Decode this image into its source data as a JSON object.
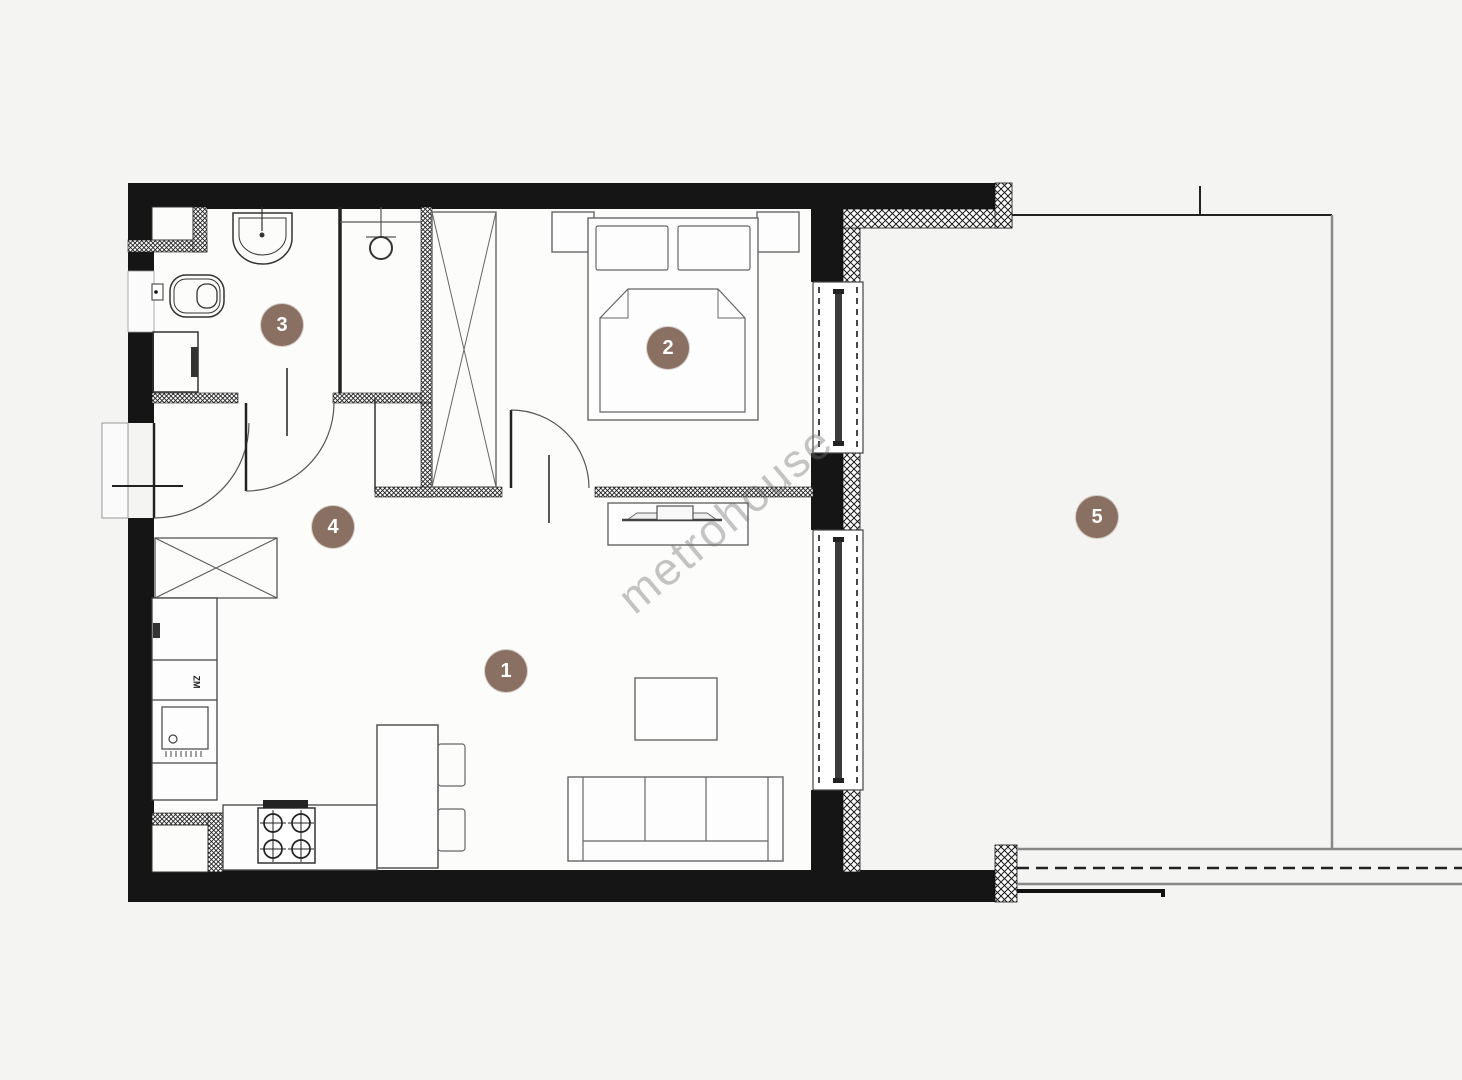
{
  "watermark": {
    "text": "metrohouse"
  },
  "rooms": [
    {
      "number": "1"
    },
    {
      "number": "2"
    },
    {
      "number": "3"
    },
    {
      "number": "4"
    },
    {
      "number": "5"
    }
  ],
  "labels": {
    "appliance": "ZM"
  },
  "colors": {
    "background": "#f4f4f3",
    "wall": "#151515",
    "furniture_line": "#555555",
    "marker": "#8a7062",
    "marker_text": "#ffffff",
    "watermark": "#6e6e6e"
  }
}
